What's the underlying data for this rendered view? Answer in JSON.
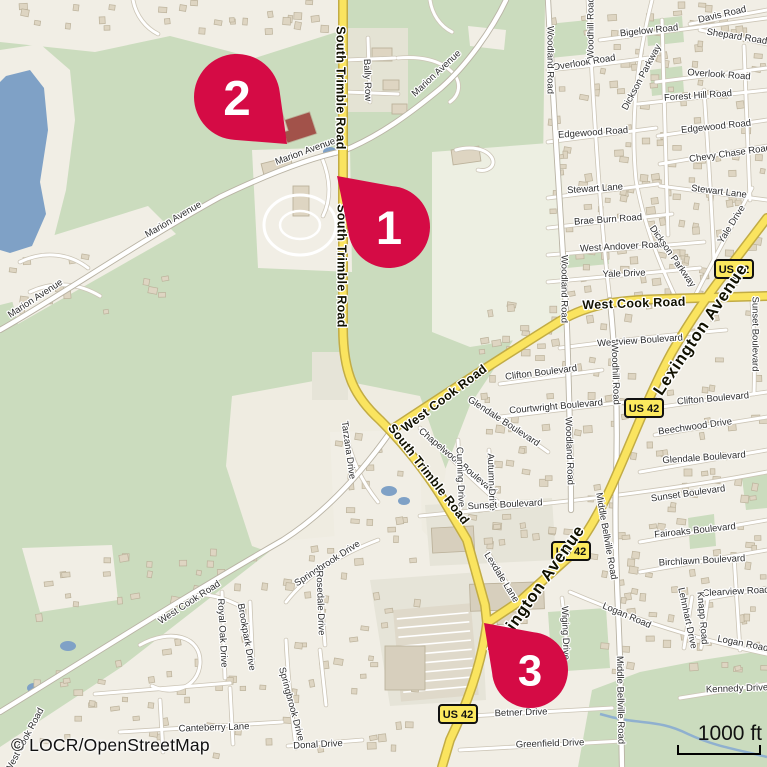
{
  "map": {
    "attribution": "© LOCR/OpenStreetMap",
    "scale_bar": {
      "label": "1000 ft"
    },
    "route_shield_label": "US 42",
    "colors": {
      "green": "#CBDCBE",
      "beige": "#F1EEE5",
      "pale_field": "#EDEFE2",
      "field": "#EFECE1",
      "gray_block": "#E6E4D8",
      "commercial": "#E4E3D4",
      "water": "#7FA1C6",
      "stream": "#8FB0CF",
      "building_fill": "#DED5C2",
      "building_stroke": "#BCB29B",
      "big_building": "#D7CFBD",
      "brick_building": "#A2524A",
      "minor_fill": "#FFFFFF",
      "minor_casing": "#CCC5B6",
      "white_major_casing": "#B9B3A4",
      "yellow_fill": "#FAE45F",
      "yellow_casing": "#C2AC45",
      "parking": "#DFD9CA",
      "marker": "#D50B45",
      "marker_number": "#FFFFFF",
      "shield_fill": "#FCE95E",
      "shield_border": "#111111",
      "label_minor": "#2F2F2F",
      "label_major": "#111100"
    },
    "markers": [
      {
        "label": "1",
        "cx": 389,
        "cy": 227,
        "r": 41,
        "tipx": 337,
        "tipy": 176
      },
      {
        "label": "2",
        "cx": 237,
        "cy": 97,
        "r": 43,
        "tipx": 287,
        "tipy": 144
      },
      {
        "label": "3",
        "cx": 530,
        "cy": 670,
        "r": 38,
        "tipx": 484,
        "tipy": 623
      }
    ],
    "shields": [
      {
        "x": 734,
        "y": 269
      },
      {
        "x": 644,
        "y": 408
      },
      {
        "x": 571,
        "y": 551
      },
      {
        "x": 458,
        "y": 714
      }
    ],
    "street_labels": [
      {
        "t": "Davis Road",
        "x": 722,
        "y": 14,
        "r": -13,
        "k": "minor"
      },
      {
        "t": "Bigelow Road",
        "x": 649,
        "y": 30,
        "r": -6,
        "k": "minor"
      },
      {
        "t": "Shepard Road",
        "x": 737,
        "y": 36,
        "r": 9,
        "k": "minor"
      },
      {
        "t": "Overlook Road",
        "x": 584,
        "y": 62,
        "r": -9,
        "k": "minor"
      },
      {
        "t": "Overlook Road",
        "x": 719,
        "y": 74,
        "r": 4,
        "k": "minor"
      },
      {
        "t": "Woodhill Road",
        "x": 590,
        "y": 28,
        "r": -90,
        "k": "minor"
      },
      {
        "t": "Woodland Road",
        "x": 551,
        "y": 60,
        "r": 90,
        "k": "minor"
      },
      {
        "t": "Dickson Parkway",
        "x": 641,
        "y": 77,
        "r": -62,
        "k": "minor"
      },
      {
        "t": "Forest Hill Road",
        "x": 698,
        "y": 95,
        "r": -4,
        "k": "minor"
      },
      {
        "t": "Edgewood Road",
        "x": 593,
        "y": 132,
        "r": -4,
        "k": "minor"
      },
      {
        "t": "Edgewood Road",
        "x": 716,
        "y": 126,
        "r": -6,
        "k": "minor"
      },
      {
        "t": "Chevy Chase Road",
        "x": 730,
        "y": 153,
        "r": -8,
        "k": "minor"
      },
      {
        "t": "Stewart Lane",
        "x": 595,
        "y": 188,
        "r": -4,
        "k": "minor"
      },
      {
        "t": "Stewart Lane",
        "x": 719,
        "y": 191,
        "r": 7,
        "k": "minor"
      },
      {
        "t": "Brae Burn Road",
        "x": 608,
        "y": 219,
        "r": -4,
        "k": "minor"
      },
      {
        "t": "West Andover Road",
        "x": 622,
        "y": 246,
        "r": -3,
        "k": "minor"
      },
      {
        "t": "Yale Drive",
        "x": 624,
        "y": 273,
        "r": -2,
        "k": "minor"
      },
      {
        "t": "Yale Drive",
        "x": 731,
        "y": 224,
        "r": -58,
        "k": "minor"
      },
      {
        "t": "Dickson Parkway",
        "x": 673,
        "y": 256,
        "r": 55,
        "k": "minor"
      },
      {
        "t": "Woodland Road",
        "x": 565,
        "y": 289,
        "r": 90,
        "k": "minor"
      },
      {
        "t": "Westview Boulevard",
        "x": 640,
        "y": 340,
        "r": -4,
        "k": "minor"
      },
      {
        "t": "Sunset Boulevard",
        "x": 756,
        "y": 334,
        "r": 90,
        "k": "minor"
      },
      {
        "t": "Clifton Boulevard",
        "x": 541,
        "y": 372,
        "r": -7,
        "k": "minor"
      },
      {
        "t": "Clifton Boulevard",
        "x": 713,
        "y": 398,
        "r": -5,
        "k": "minor"
      },
      {
        "t": "Courtwright Boulevard",
        "x": 556,
        "y": 406,
        "r": -5,
        "k": "minor"
      },
      {
        "t": "Beechwood Drive",
        "x": 695,
        "y": 426,
        "r": -8,
        "k": "minor"
      },
      {
        "t": "Glendale Boulevard",
        "x": 504,
        "y": 421,
        "r": 33,
        "k": "minor"
      },
      {
        "t": "Glendale Boulevard",
        "x": 704,
        "y": 457,
        "r": -4,
        "k": "minor"
      },
      {
        "t": "Chapelwood Boulevard",
        "x": 458,
        "y": 461,
        "r": 40,
        "k": "minor"
      },
      {
        "t": "Cunning Drive",
        "x": 461,
        "y": 477,
        "r": 88,
        "k": "minor"
      },
      {
        "t": "Autumn Drive",
        "x": 492,
        "y": 482,
        "r": 88,
        "k": "minor"
      },
      {
        "t": "Woodland Road",
        "x": 570,
        "y": 451,
        "r": 88,
        "k": "minor"
      },
      {
        "t": "Woodhill Road",
        "x": 616,
        "y": 374,
        "r": 88,
        "k": "minor"
      },
      {
        "t": "Sunset Boulevard",
        "x": 505,
        "y": 504,
        "r": -3,
        "k": "minor"
      },
      {
        "t": "Sunset Boulevard",
        "x": 688,
        "y": 493,
        "r": -8,
        "k": "minor"
      },
      {
        "t": "Fairoaks Boulevard",
        "x": 695,
        "y": 530,
        "r": -6,
        "k": "minor"
      },
      {
        "t": "Birchlawn Boulevard",
        "x": 702,
        "y": 560,
        "r": -3,
        "k": "minor"
      },
      {
        "t": "Middle Bellville Road",
        "x": 607,
        "y": 536,
        "r": 80,
        "k": "minor"
      },
      {
        "t": "Middle Bellville Road",
        "x": 621,
        "y": 700,
        "r": 89,
        "k": "minor"
      },
      {
        "t": "Clearview Road",
        "x": 736,
        "y": 591,
        "r": -3,
        "k": "minor"
      },
      {
        "t": "Lehnhart Drive",
        "x": 688,
        "y": 618,
        "r": 78,
        "k": "minor"
      },
      {
        "t": "Knapp Road",
        "x": 703,
        "y": 618,
        "r": 85,
        "k": "minor"
      },
      {
        "t": "Logan Road",
        "x": 627,
        "y": 615,
        "r": 23,
        "k": "minor"
      },
      {
        "t": "Logan Road",
        "x": 743,
        "y": 643,
        "r": 11,
        "k": "minor"
      },
      {
        "t": "Kennedy Drive",
        "x": 737,
        "y": 688,
        "r": -2,
        "k": "minor"
      },
      {
        "t": "Betner Drive",
        "x": 521,
        "y": 712,
        "r": -2,
        "k": "minor"
      },
      {
        "t": "Greenfield Drive",
        "x": 550,
        "y": 743,
        "r": -2,
        "k": "minor"
      },
      {
        "t": "Lexdale Lane",
        "x": 502,
        "y": 577,
        "r": 58,
        "k": "minor"
      },
      {
        "t": "Wiging Drive",
        "x": 566,
        "y": 633,
        "r": 88,
        "k": "minor"
      },
      {
        "t": "Canteberry Lane",
        "x": 214,
        "y": 727,
        "r": -2,
        "k": "minor"
      },
      {
        "t": "Donal Drive",
        "x": 318,
        "y": 744,
        "r": -3,
        "k": "minor"
      },
      {
        "t": "Royal Oak Drive",
        "x": 223,
        "y": 633,
        "r": 87,
        "k": "minor"
      },
      {
        "t": "Brookpark Drive",
        "x": 247,
        "y": 637,
        "r": 80,
        "k": "minor"
      },
      {
        "t": "Springbrook Drive",
        "x": 327,
        "y": 563,
        "r": -33,
        "k": "minor"
      },
      {
        "t": "Springbrook Drive",
        "x": 292,
        "y": 704,
        "r": 75,
        "k": "minor"
      },
      {
        "t": "Rosedale Drive",
        "x": 321,
        "y": 603,
        "r": 88,
        "k": "minor"
      },
      {
        "t": "West Cook Road",
        "x": 189,
        "y": 602,
        "r": -33,
        "k": "minor"
      },
      {
        "t": "West Cook Road",
        "x": 24,
        "y": 740,
        "r": -62,
        "k": "minor"
      },
      {
        "t": "Marion Avenue",
        "x": 35,
        "y": 298,
        "r": -33,
        "k": "minor"
      },
      {
        "t": "Marion Avenue",
        "x": 173,
        "y": 219,
        "r": -30,
        "k": "minor"
      },
      {
        "t": "Marion Avenue",
        "x": 305,
        "y": 151,
        "r": -20,
        "k": "minor"
      },
      {
        "t": "Marion Avenue",
        "x": 436,
        "y": 73,
        "r": -43,
        "k": "minor"
      },
      {
        "t": "Bally Row",
        "x": 368,
        "y": 80,
        "r": 88,
        "k": "minor"
      },
      {
        "t": "Tarzana Drive",
        "x": 349,
        "y": 450,
        "r": 82,
        "k": "minor"
      },
      {
        "t": "South Trimble Road",
        "x": 341,
        "y": 88,
        "r": 90,
        "k": "major"
      },
      {
        "t": "South Trimble Road",
        "x": 342,
        "y": 266,
        "r": 90,
        "k": "major"
      },
      {
        "t": "South Trimble Road",
        "x": 429,
        "y": 474,
        "r": 52,
        "k": "major"
      },
      {
        "t": "West Cook Road",
        "x": 444,
        "y": 398,
        "r": -37,
        "k": "major"
      },
      {
        "t": "West Cook Road",
        "x": 634,
        "y": 303,
        "r": -2,
        "k": "major"
      },
      {
        "t": "Lexington Avenue",
        "x": 700,
        "y": 329,
        "r": -56,
        "k": "trunk"
      },
      {
        "t": "Lexington Avenue",
        "x": 536,
        "y": 590,
        "r": -55,
        "k": "trunk"
      }
    ],
    "land": [
      {
        "c": "beige",
        "d": "M545,0 L767,0 L767,767 L415,767 L385,650 L395,600 L420,560 L440,520 L445,470 L470,405 L512,342 L537,295 L543,170 Z"
      },
      {
        "c": "beige",
        "d": "M0,0 L343,0 L343,30 L255,58 L170,36 L95,52 L0,42 Z"
      },
      {
        "c": "beige",
        "d": "M0,50 L40,44 L70,70 L75,120 L66,190 L52,245 L20,300 L0,305 Z"
      },
      {
        "c": "beige",
        "d": "M0,252 L148,206 L176,234 L18,324 Z"
      },
      {
        "c": "commercial",
        "d": "M345,28 L408,28 L408,112 L345,112 Z"
      },
      {
        "c": "beige",
        "d": "M252,150 L350,147 L352,272 L258,268 Z"
      },
      {
        "c": "field",
        "d": "M232,396 L330,378 L420,396 L446,470 L432,562 L330,574 L252,546 L226,466 Z"
      },
      {
        "c": "pale_field",
        "d": "M432,152 L562,142 L566,332 L470,347 L432,332 Z"
      },
      {
        "c": "beige",
        "d": "M0,747 L120,668 L283,541 L420,528 L452,562 L434,767 L0,767 Z"
      },
      {
        "c": "beige",
        "d": "M22,548 L112,545 L118,600 L40,612 Z"
      },
      {
        "c": "beige",
        "d": "M330,432 L420,430 L422,545 L335,548 Z"
      },
      {
        "c": "gray_block",
        "d": "M312,352 L348,352 L348,400 L312,400 Z"
      },
      {
        "c": "gray_block",
        "d": "M425,505 L552,498 L556,560 L430,566 Z"
      },
      {
        "c": "gray_block",
        "d": "M370,580 L480,572 L486,700 L390,706 Z"
      },
      {
        "c": "beige",
        "d": "M468,26 L506,30 L504,50 L470,46 Z"
      }
    ],
    "green_patches": [
      "M578,767 L592,690 L640,672 L702,660 L767,650 L767,767 Z",
      "M548,612 L606,608 L610,668 L552,672 Z",
      "M548,24 L588,20 L590,54 L550,58 Z",
      "M646,20 L682,16 L684,42 L648,46 Z",
      "M650,70 L682,66 L684,92 L652,96 Z",
      "M742,478 L767,474 L767,508 L746,510 Z",
      "M688,518 L714,514 L716,546 L690,549 Z",
      "M566,254 L608,250 L609,264 L567,268 Z"
    ],
    "water": {
      "lake": "M6,76 L30,70 L44,88 L48,130 L40,182 L46,214 L32,246 L10,253 L0,250 L0,82 Z",
      "ponds": [
        {
          "x": 330,
          "y": 152,
          "rx": 7,
          "ry": 5
        },
        {
          "x": 389,
          "y": 491,
          "rx": 8,
          "ry": 5
        },
        {
          "x": 404,
          "y": 501,
          "rx": 6,
          "ry": 4
        },
        {
          "x": 68,
          "y": 646,
          "rx": 8,
          "ry": 5
        },
        {
          "x": 34,
          "y": 688,
          "rx": 7,
          "ry": 5
        }
      ],
      "stream": "M600,714 C640,726 656,718 688,734 C716,747 740,750 767,757"
    },
    "roads": {
      "minor": [
        "M690,24 L767,10",
        "M600,40 C660,32 710,26 767,18",
        "M700,30 L767,44",
        "M548,70 C590,66 620,62 648,58",
        "M656,82 L767,68",
        "M638,104 L767,90",
        "M548,142 L656,128",
        "M658,136 L767,120",
        "M660,164 L767,146",
        "M548,198 L658,184",
        "M660,186 L767,200",
        "M548,228 L672,214",
        "M548,255 L704,242",
        "M548,282 L700,268",
        "M752,188 C730,230 712,262 694,298",
        "M588,0 C593,100 600,220 610,300",
        "M652,0 C637,60 630,120 636,180 C644,226 660,266 678,302",
        "M662,20 C664,90 666,160 668,235",
        "M704,90 C708,150 712,210 714,262",
        "M744,46 C746,100 748,150 750,200",
        "M560,348 C620,340 680,334 726,330",
        "M752,302 C754,334 755,362 754,394",
        "M500,384 L602,370",
        "M640,410 L767,392",
        "M500,417 L642,400",
        "M655,435 L767,417",
        "M470,398 C495,416 520,432 548,452",
        "M640,472 L767,450",
        "M420,428 C445,452 470,478 498,502",
        "M458,440 L461,508",
        "M489,450 L492,508",
        "M420,516 C520,506 640,496 767,472",
        "M640,542 L767,520",
        "M640,572 L767,550",
        "M700,600 L767,588",
        "M570,592 C640,622 700,640 767,654",
        "M680,698 L767,684",
        "M692,597 L684,648",
        "M708,597 L701,648",
        "M734,556 L740,650",
        "M470,716 L612,708",
        "M460,750 L622,741",
        "M562,598 C566,630 568,655 564,672 C561,684 552,690 542,694",
        "M488,552 C498,570 508,586 520,602",
        "M222,592 L225,678",
        "M250,602 L253,668",
        "M286,602 C306,576 336,556 378,540",
        "M286,640 C288,680 292,715 296,748",
        "M320,582 L325,645",
        "M120,732 L282,722",
        "M288,746 L362,740",
        "M95,694 L230,683",
        "M160,700 L163,752",
        "M230,688 L233,744",
        "M140,645 C170,628 202,636 200,664 C198,688 172,696 152,686",
        "M320,650 L326,705",
        "M180,600 C200,590 220,596 240,606",
        "M368,38 L370,102",
        "M346,60 L395,58",
        "M346,92 L398,94",
        "M398,58 C420,56 440,60 452,72 C462,82 460,95 450,102",
        "M430,0 C432,14 440,26 452,32",
        "M456,150 C470,146 486,148 492,158 C496,166 488,172 478,170",
        "M133,0 C136,16 146,28 158,34",
        "M322,158 C331,180 331,200 323,216",
        "M345,428 C351,460 362,482 378,502",
        "M20,262 C45,250 70,254 88,268",
        "M30,292 C55,280 80,284 100,296"
      ],
      "white_major": [
        "M0,330 C60,296 140,241 220,197 C268,174 310,158 343,151 C380,136 412,112 441,88 C466,66 492,30 506,0",
        "M0,712 C85,660 182,598 283,540 C322,515 358,478 391,431",
        "M610,300 C616,360 618,420 616,480 C614,540 618,600 620,660 L622,767",
        "M548,0 C555,140 564,260 567,330 C570,420 571,468 571,510"
      ],
      "yellow": [
        "M343,0 L343,328 C343,376 356,398 380,420 C402,442 422,466 441,496 L467,540 L485,605 L487,623 C482,662 468,702 450,740 L442,767",
        "M391,430 C450,391 520,346 560,321 C592,302 625,300 662,299 L767,296",
        "M767,218 L735,260 C706,297 690,321 672,352 C651,390 636,431 616,476 C601,511 586,536 570,556 L520,601 L487,623"
      ]
    },
    "building_zones": [
      {
        "x": 552,
        "y": 4,
        "w": 212,
        "h": 292,
        "n": 150
      },
      {
        "x": 472,
        "y": 302,
        "w": 292,
        "h": 256,
        "n": 120
      },
      {
        "x": 600,
        "y": 562,
        "w": 165,
        "h": 110,
        "n": 40
      },
      {
        "x": 25,
        "y": 548,
        "w": 395,
        "h": 210,
        "n": 100
      },
      {
        "x": 4,
        "y": 2,
        "w": 330,
        "h": 30,
        "n": 26
      },
      {
        "x": 8,
        "y": 252,
        "w": 160,
        "h": 62,
        "n": 14
      },
      {
        "x": 336,
        "y": 436,
        "w": 80,
        "h": 105,
        "n": 16
      }
    ],
    "big_buildings": [
      {
        "x": 372,
        "y": 48,
        "w": 20,
        "h": 13,
        "r": 0
      },
      {
        "x": 383,
        "y": 80,
        "w": 16,
        "h": 10,
        "r": 0
      },
      {
        "x": 392,
        "y": 104,
        "w": 15,
        "h": 10,
        "r": 0
      },
      {
        "x": 452,
        "y": 148,
        "w": 28,
        "h": 15,
        "r": -8
      },
      {
        "x": 470,
        "y": 583,
        "w": 74,
        "h": 27,
        "r": -2,
        "c": "big_building"
      },
      {
        "x": 497,
        "y": 612,
        "w": 30,
        "h": 12,
        "r": -2
      },
      {
        "x": 385,
        "y": 646,
        "w": 40,
        "h": 44,
        "r": 0,
        "c": "big_building"
      },
      {
        "x": 432,
        "y": 527,
        "w": 42,
        "h": 25,
        "r": -3,
        "c": "big_building"
      },
      {
        "x": 283,
        "y": 116,
        "w": 31,
        "h": 23,
        "r": -18,
        "c": "brick_building"
      },
      {
        "x": 253,
        "y": 111,
        "w": 32,
        "h": 25,
        "r": -18
      },
      {
        "x": 262,
        "y": 160,
        "w": 30,
        "h": 11,
        "r": -14
      },
      {
        "x": 293,
        "y": 186,
        "w": 16,
        "h": 30,
        "r": 0
      }
    ],
    "fairground": {
      "cx": 300,
      "cy": 225,
      "rx1": 36,
      "ry1": 30,
      "rx2": 20,
      "ry2": 14
    },
    "parking": {
      "x": 393,
      "y": 610,
      "w": 78,
      "h": 92,
      "rot": -5,
      "rows": 9
    }
  }
}
